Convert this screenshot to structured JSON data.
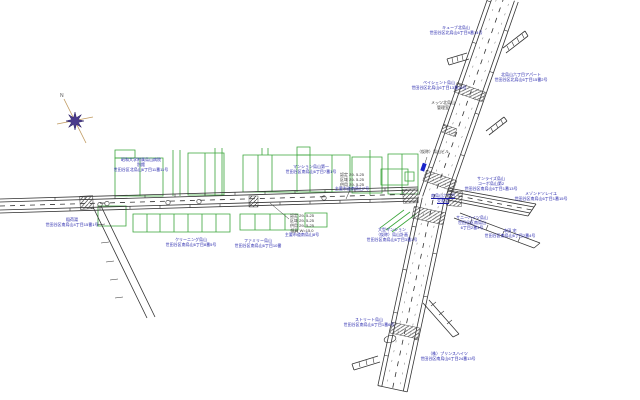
{
  "colors": {
    "background": "#ffffff",
    "road_line": "#333333",
    "building_green": "#3aa53a",
    "label_blue": "#1c1ca8",
    "label_black": "#333333",
    "compass_purple": "#4a3a8c",
    "compass_axis_tan": "#c09a60",
    "signal_marker_blue": "#1823c8",
    "hatch_gray": "#444444"
  },
  "compass": {
    "north_label": "N"
  },
  "labels": [
    {
      "name": "hospital-label",
      "x": 141,
      "y": 157,
      "color": "blue",
      "lines": [
        "昭和大学附属烏山病院",
        "別館",
        "世田谷区北烏山6丁目11番11号"
      ]
    },
    {
      "name": "mansion-label",
      "x": 311,
      "y": 164,
      "color": "blue",
      "lines": [
        "マンション烏山第一",
        "世田谷区南烏山6丁目7番1号"
      ]
    },
    {
      "name": "road-register-1-block",
      "x": 352,
      "y": 172,
      "color": "black",
      "lines": [
        "認定 29- 5-25",
        "区域 29- 5-25",
        "供用 29- 5-25"
      ]
    },
    {
      "name": "road-register-1-caption",
      "x": 352,
      "y": 186,
      "color": "blue",
      "lines": [
        "主要市道南烏山7号"
      ]
    },
    {
      "name": "kasho-building-label",
      "x": 433,
      "y": 149,
      "color": "black",
      "lines": [
        "（仮称）烏山ビル"
      ]
    },
    {
      "name": "intersection-name-label",
      "x": 443,
      "y": 193,
      "color": "blue",
      "underline": true,
      "lines": [
        "南烏山六丁目",
        "交差点"
      ]
    },
    {
      "name": "cube-kitakarasuyama-label",
      "x": 456,
      "y": 25,
      "color": "blue",
      "lines": [
        "キューブ北烏山",
        "世田谷区北烏山6丁目9番14号"
      ]
    },
    {
      "name": "kitakarasuyama-apartment-label",
      "x": 521,
      "y": 72,
      "color": "blue",
      "lines": [
        "北烏山六丁目アパート",
        "世田谷区北烏山6丁目15番2号"
      ]
    },
    {
      "name": "patience-karasuyama-label",
      "x": 439,
      "y": 80,
      "color": "blue",
      "lines": [
        "ペイシェント烏山",
        "世田谷区北烏山6丁目13番16号"
      ]
    },
    {
      "name": "mets-kitakarasuyama-label",
      "x": 443,
      "y": 100,
      "color": "black",
      "lines": [
        "メッツ北烏山",
        "管理室"
      ]
    },
    {
      "name": "sunrise-karasuyama-label",
      "x": 491,
      "y": 176,
      "color": "blue",
      "lines": [
        "サンライズ烏山",
        "コーポ烏山第2",
        "世田谷区南烏山6丁目1番13号"
      ]
    },
    {
      "name": "maison-label",
      "x": 541,
      "y": 191,
      "color": "blue",
      "lines": [
        "メゾンドソレイユ",
        "世田谷区南烏山6丁目1番15号"
      ]
    },
    {
      "name": "sunny-heights-label",
      "x": 472,
      "y": 215,
      "color": "blue",
      "lines": [
        "サニーハイツ烏山",
        "世田谷区南烏山",
        "6丁目2番3号"
      ]
    },
    {
      "name": "honda-residence-label",
      "x": 510,
      "y": 228,
      "color": "blue",
      "lines": [
        "本田 宅",
        "世田谷区南烏山6丁目2番4号"
      ]
    },
    {
      "name": "street-karasuyama-label",
      "x": 369,
      "y": 317,
      "color": "blue",
      "lines": [
        "ストリート烏山",
        "世田谷区南烏山6丁目1番6号"
      ]
    },
    {
      "name": "prince-heights-label",
      "x": 448,
      "y": 351,
      "color": "blue",
      "lines": [
        "（株）プリンスハイツ",
        "世田谷区南烏山6丁目24番13号"
      ]
    },
    {
      "name": "inariyu-label",
      "x": 72,
      "y": 217,
      "color": "blue",
      "lines": [
        "稲荷湯",
        "世田谷区南烏山4丁目15番1号"
      ]
    },
    {
      "name": "cleaning-label",
      "x": 191,
      "y": 237,
      "color": "blue",
      "lines": [
        "クリーニング烏山",
        "世田谷区南烏山6丁目8番5号"
      ]
    },
    {
      "name": "family-karasuyama-label",
      "x": 258,
      "y": 238,
      "color": "blue",
      "lines": [
        "ファミリー烏山",
        "世田谷区南烏山6丁目10番"
      ]
    },
    {
      "name": "road-register-2-block",
      "x": 302,
      "y": 213,
      "color": "black",
      "lines": [
        "認定 29- 5-25",
        "区域 29- 5-25",
        "供用 29- 5-25",
        "幅員 W=15.0"
      ]
    },
    {
      "name": "road-register-2-caption",
      "x": 302,
      "y": 232,
      "color": "blue",
      "lines": [
        "主要市道南烏山8号"
      ]
    },
    {
      "name": "large-mansion-label",
      "x": 392,
      "y": 227,
      "color": "blue",
      "lines": [
        "大型マンション",
        "（仮称）烏山計画",
        "世田谷区南烏山6丁目3番1号"
      ]
    }
  ]
}
